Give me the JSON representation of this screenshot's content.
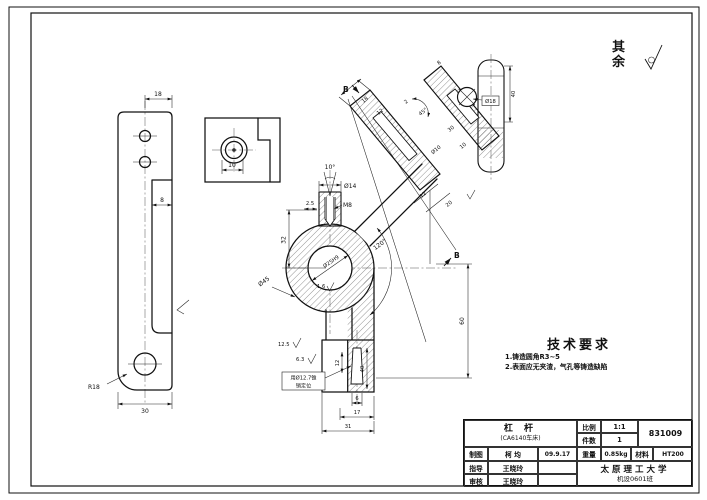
{
  "surface_note": {
    "label": "其余"
  },
  "tech_requirements": {
    "title": "技术要求",
    "item1": "1.铸造圆角R3~5",
    "item2": "2.表面应无夹渣，气孔等铸造缺陷"
  },
  "title_block": {
    "part_name": "杠 杆",
    "part_model": "(CA6140车床)",
    "scale_label": "比例",
    "scale": "1:1",
    "qty_label": "件数",
    "qty": "1",
    "drawing_no": "831009",
    "drawn_label": "制图",
    "drawn_by": "柯 均",
    "date": "09.9.17",
    "weight_label": "重量",
    "weight": "0.85kg",
    "material_label": "材料",
    "material": "HT200",
    "advisor_label": "指导",
    "advisor": "王晓玲",
    "checker_label": "审核",
    "checker": "王晓玲",
    "school": "太原理工大学",
    "class_name": "机设0601班"
  },
  "dims": {
    "left_top_width": "18",
    "left_recess": "8",
    "left_bottom_width": "30",
    "left_radius": "R18",
    "section_offset": "10",
    "taper_angle": "10°",
    "boss_dia": "Ø14",
    "thread": "M8",
    "step": "2.5",
    "height32": "32",
    "hub_dia": "Ø45",
    "hub_hole": "Ø25H9",
    "arm_angle": "120°",
    "ra_hole": "1.6",
    "ra_face": "6.3",
    "ra_bottom": "12.5",
    "note_line1": "用Ø12.7锥",
    "note_line2": "销定位",
    "pin_offset": "6",
    "pad_width": "17",
    "base_width": "31",
    "height60": "60",
    "pad12": "12",
    "pad40": "40",
    "section_label": "B",
    "arm_width18": "18",
    "arm_bore12": "12",
    "arm_gap2": "2",
    "arm_angle45": "45°",
    "arm_len30": "30",
    "arm_len10": "10",
    "arm_hole10": "Ø10",
    "boss18": "Ø18",
    "arm_len20": "20",
    "end_w8": "8",
    "end_h40": "40"
  }
}
